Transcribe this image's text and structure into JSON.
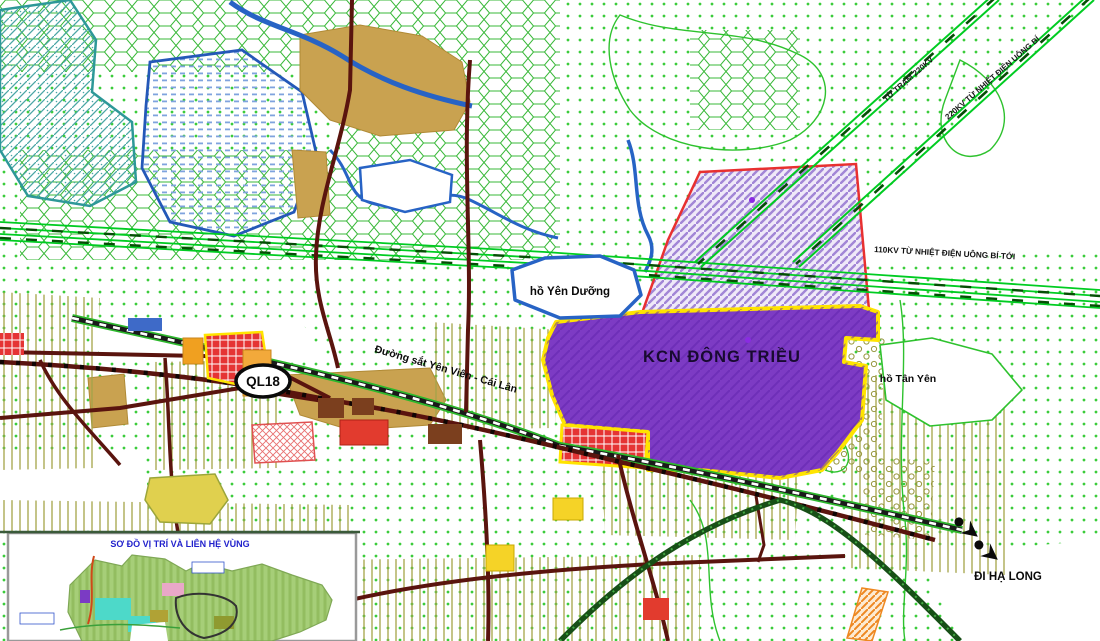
{
  "map": {
    "industrial_zone": {
      "label": "KCN ĐÔNG TRIỀU"
    },
    "lakes": {
      "yen_duong": "hồ Yên Dưỡng",
      "tan_yen": "hồ Tân Yên"
    },
    "roads": {
      "route_badge": "QL18",
      "railway_label": "Đường sắt Yên Viên - Cái Lân",
      "direction_label": "ĐI HẠ LONG"
    },
    "power_lines": {
      "line_110kv": "110KV TỪ NHIỆT ĐIỆN UÔNG BÍ TỚI",
      "line_220kv_station": "TỪ TRẠM 220KV",
      "line_220kv_uong_bi": "220KV TỪ NHIỆT ĐIỆN UÔNG BÍ"
    },
    "inset": {
      "title": "SƠ ĐỒ VỊ TRÍ VÀ LIÊN HỆ VÙNG"
    },
    "colors": {
      "industrial_zone_fill": "#7D3BC4",
      "industrial_zone_border": "#FFE400",
      "expansion_area_border": "#E83030",
      "powerline_green": "#00CC22",
      "road_dark_red": "#5A140E",
      "water_blue": "#2763C5",
      "dot_green": "#3BCC3B",
      "hill_tan": "#C9A250"
    }
  }
}
